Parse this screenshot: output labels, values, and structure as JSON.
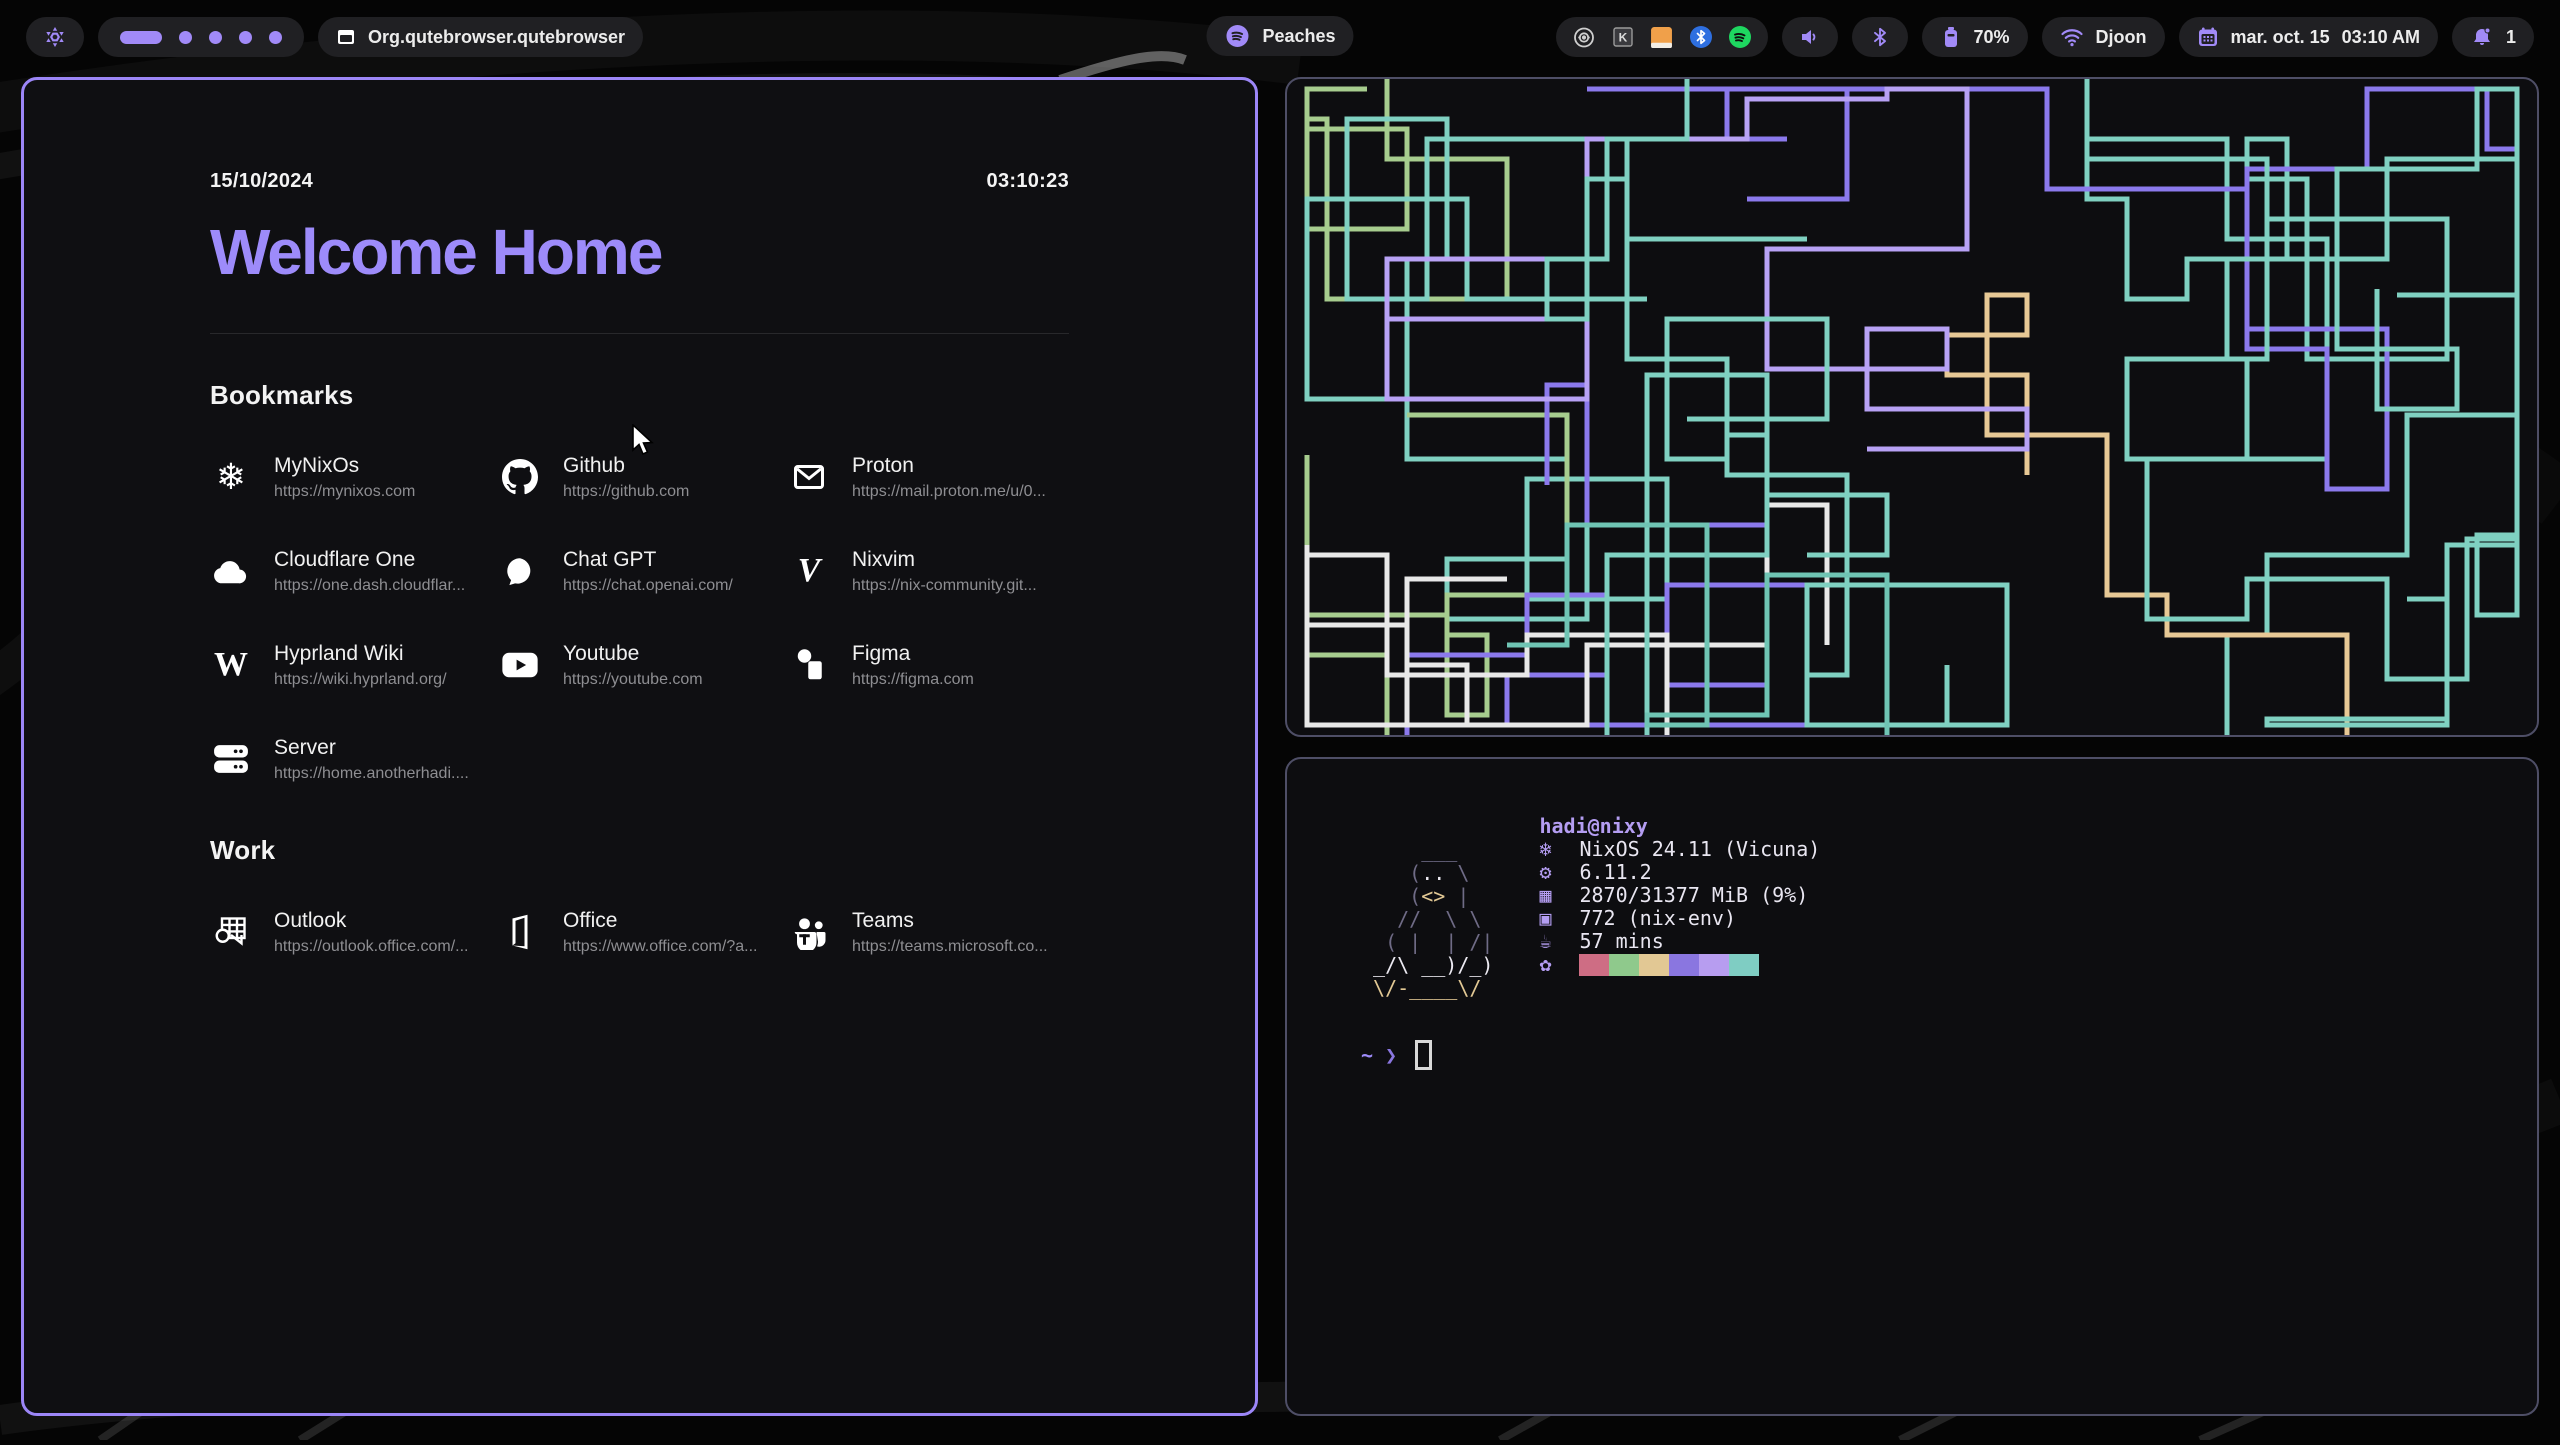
{
  "colors": {
    "accent": "#a18af7",
    "heading_purple": "#9d8bfa",
    "active_border": "#9c86f7",
    "inactive_border": "#4e4e66",
    "pill_bg": "#202023",
    "spotify_green": "#1ed760",
    "bluetooth_blue": "#2e6fe0",
    "notes_orange": "#f0a04a"
  },
  "topbar": {
    "nix_icon": "nixos-logo-icon",
    "workspaces": {
      "count": 5,
      "active_index": 0
    },
    "window_icon": "window-icon",
    "window_title": "Org.qutebrowser.qutebrowser",
    "media": {
      "icon": "spotify-icon",
      "label": "Peaches"
    },
    "tray_icons": [
      "lens-icon",
      "keepass-icon",
      "notes-icon",
      "bluetooth-badge-icon",
      "spotify-badge-icon"
    ],
    "volume_icon": "speaker-icon",
    "bluetooth_icon": "bluetooth-icon",
    "battery": {
      "icon": "battery-icon",
      "percent": "70%"
    },
    "network": {
      "icon": "wifi-icon",
      "ssid": "Djoon"
    },
    "clock": {
      "icon": "calendar-icon",
      "date": "mar. oct. 15",
      "time": "03:10 AM"
    },
    "notifications": {
      "icon": "bell-icon",
      "count": "1"
    }
  },
  "browser": {
    "date": "15/10/2024",
    "time": "03:10:23",
    "title": "Welcome Home",
    "sections": [
      {
        "heading": "Bookmarks",
        "items": [
          {
            "name": "MyNixOs",
            "url": "https://mynixos.com",
            "icon": "nixos-icon"
          },
          {
            "name": "Github",
            "url": "https://github.com",
            "icon": "github-icon"
          },
          {
            "name": "Proton",
            "url": "https://mail.proton.me/u/0...",
            "icon": "mail-icon"
          },
          {
            "name": "Cloudflare One",
            "url": "https://one.dash.cloudflar...",
            "icon": "cloud-icon"
          },
          {
            "name": "Chat GPT",
            "url": "https://chat.openai.com/",
            "icon": "chat-icon"
          },
          {
            "name": "Nixvim",
            "url": "https://nix-community.git...",
            "icon": "nixvim-icon"
          },
          {
            "name": "Hyprland Wiki",
            "url": "https://wiki.hyprland.org/",
            "icon": "wikipedia-icon"
          },
          {
            "name": "Youtube",
            "url": "https://youtube.com",
            "icon": "youtube-icon"
          },
          {
            "name": "Figma",
            "url": "https://figma.com",
            "icon": "figma-icon"
          },
          {
            "name": "Server",
            "url": "https://home.anotherhadi....",
            "icon": "server-icon"
          }
        ]
      },
      {
        "heading": "Work",
        "items": [
          {
            "name": "Outlook",
            "url": "https://outlook.office.com/...",
            "icon": "outlook-icon"
          },
          {
            "name": "Office",
            "url": "https://www.office.com/?a...",
            "icon": "office-icon"
          },
          {
            "name": "Teams",
            "url": "https://teams.microsoft.co...",
            "icon": "teams-icon"
          }
        ]
      }
    ]
  },
  "fastfetch": {
    "user_host": "hadi@nixy",
    "ascii_colors": {
      "g": "#6f6b86",
      "w": "#eceaf2",
      "y": "#e2c894"
    },
    "ascii": [
      [
        {
          "t": "     ___",
          "c": "g"
        }
      ],
      [
        {
          "t": "    (",
          "c": "g"
        },
        {
          "t": "..",
          "c": "w"
        },
        {
          "t": " \\",
          "c": "g"
        }
      ],
      [
        {
          "t": "    (",
          "c": "g"
        },
        {
          "t": "<>",
          "c": "y"
        },
        {
          "t": " |",
          "c": "g"
        }
      ],
      [
        {
          "t": "   //  \\ \\",
          "c": "g"
        }
      ],
      [
        {
          "t": "  ( |  | /|",
          "c": "g"
        }
      ],
      [
        {
          "t": " _/\\ __)/_)",
          "c": "w"
        }
      ],
      [
        {
          "t": " \\/-____\\/",
          "c": "y"
        }
      ]
    ],
    "rows": [
      {
        "icon": "nix-snowflake-icon",
        "glyph": "❄",
        "text": "NixOS 24.11 (Vicuna)"
      },
      {
        "icon": "kernel-icon",
        "glyph": "⚙",
        "text": "6.11.2"
      },
      {
        "icon": "memory-icon",
        "glyph": "▦",
        "text": "2870/31377 MiB (9%)"
      },
      {
        "icon": "packages-icon",
        "glyph": "▣",
        "text": "772 (nix-env)"
      },
      {
        "icon": "uptime-icon",
        "glyph": "☕",
        "text": "57 mins"
      }
    ],
    "palette_icon": {
      "icon": "palette-icon",
      "glyph": "✿"
    },
    "palette": [
      "#ce6d84",
      "#8fc98c",
      "#e2c894",
      "#8a76e0",
      "#b79df0",
      "#7fcdc3"
    ],
    "prompt": {
      "path": "~",
      "symbol": "❯"
    }
  },
  "pipes": {
    "colors": [
      "#7fd0c1",
      "#7fd0c1",
      "#7fd0c1",
      "#8b79ec",
      "#8b79ec",
      "#a6cc8e",
      "#e7c895",
      "#e8e8e8",
      "#b7a1f5",
      "#6fc4b4"
    ]
  }
}
